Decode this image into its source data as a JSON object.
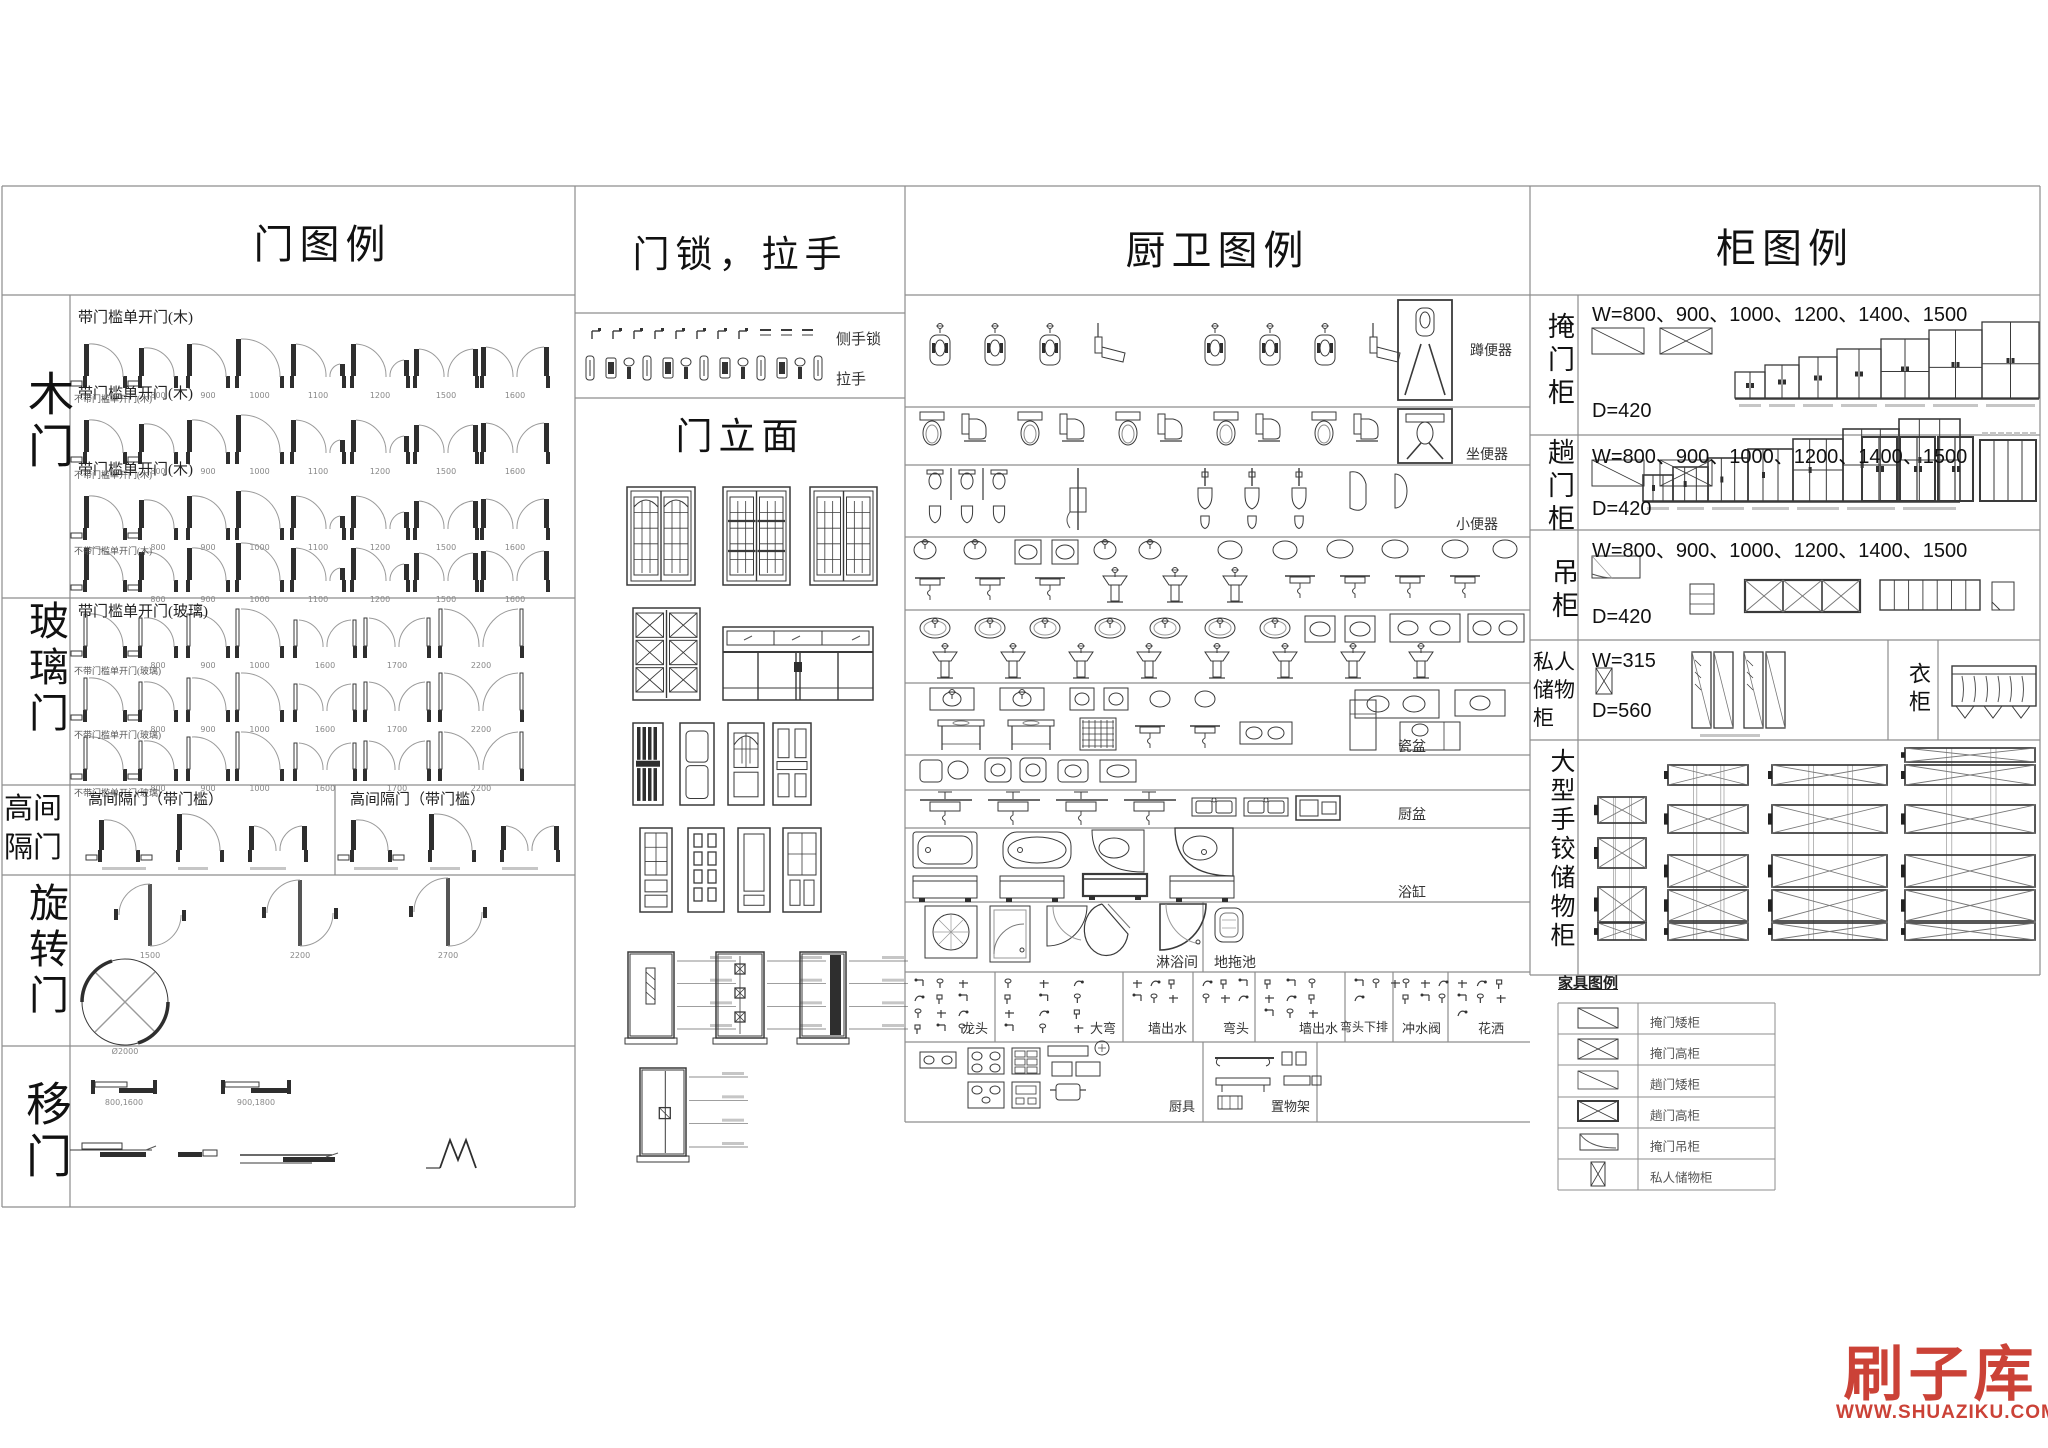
{
  "doors": {
    "title": "门图例",
    "sections": [
      {
        "label": "木门",
        "caption": "带门槛单开门(木)",
        "sub_caption": "不带门槛单开门(木)",
        "dims": [
          "800",
          "900",
          "1000",
          "1100",
          "1200",
          "1500",
          "1600"
        ]
      },
      {
        "label": "玻璃门",
        "caption": "带门槛单开门(玻璃)",
        "sub_caption": "不带门槛单开门(玻璃)",
        "dims": [
          "800",
          "900",
          "1000",
          "1600",
          "1700",
          "2200"
        ]
      },
      {
        "label": "高间隔门",
        "cells": [
          {
            "caption": "高间隔门（带门槛）"
          },
          {
            "caption": "高间隔门（带门槛）"
          }
        ]
      },
      {
        "label": "旋转门",
        "dims": [
          "1500",
          "2200",
          "2700"
        ],
        "circle_dim": "Ø2000"
      },
      {
        "label": "移门",
        "dims": [
          "800,1600",
          "900,1800"
        ]
      }
    ]
  },
  "locks": {
    "title": "门锁，拉手",
    "lock_label": "侧手锁",
    "handle_label": "拉手",
    "elevation_title": "门立面"
  },
  "kitchen_bath": {
    "title": "厨卫图例",
    "row_labels": [
      "蹲便器",
      "坐便器",
      "小便器",
      "瓷盆",
      "厨盆",
      "浴缸"
    ],
    "shower_label": "淋浴间",
    "mop_label": "地拖池",
    "fitting_cells": [
      "龙头",
      "大弯",
      "墙出水",
      "弯头",
      "墙出水",
      "弯头下排",
      "冲水阀",
      "花洒"
    ],
    "bottom_cells": [
      "厨具",
      "置物架"
    ]
  },
  "cabinets": {
    "title": "柜图例",
    "sections": [
      {
        "label": "掩门柜",
        "w_spec": "W=800、900、1000、1200、1400、1500",
        "d_spec": "D=420"
      },
      {
        "label": "趟门柜",
        "w_spec": "W=800、900、1000、1200、1400、1500",
        "d_spec": "D=420"
      },
      {
        "label": "吊柜",
        "w_spec": "W=800、900、1000、1200、1400、1500",
        "d_spec": "D=420"
      },
      {
        "label": "私人储物柜",
        "w_spec": "W=315",
        "d_spec": "D=560",
        "wardrobe_label": "衣柜"
      },
      {
        "label": "大型手铰储物柜"
      }
    ],
    "furniture": {
      "title": "家具图例",
      "items": [
        "掩门矮柜",
        "掩门高柜",
        "趟门矮柜",
        "趟门高柜",
        "掩门吊柜",
        "私人储物柜"
      ]
    }
  },
  "watermark": {
    "brand": "刷子库",
    "site": "WWW.SHUAZIKU.COM",
    "color": "#cb4237"
  }
}
